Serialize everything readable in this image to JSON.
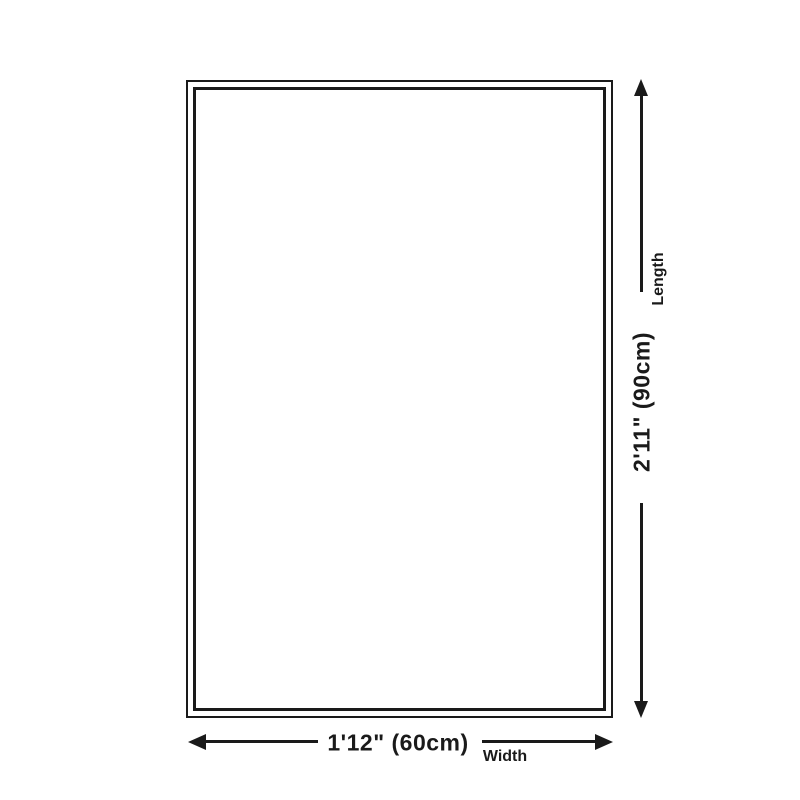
{
  "diagram": {
    "length": {
      "value": "2'11\" (90cm)",
      "label": "Length"
    },
    "width": {
      "value": "1'12\" (60cm)",
      "label": "Width"
    },
    "colors": {
      "line": "#1a1a1a",
      "background": "#ffffff"
    }
  }
}
